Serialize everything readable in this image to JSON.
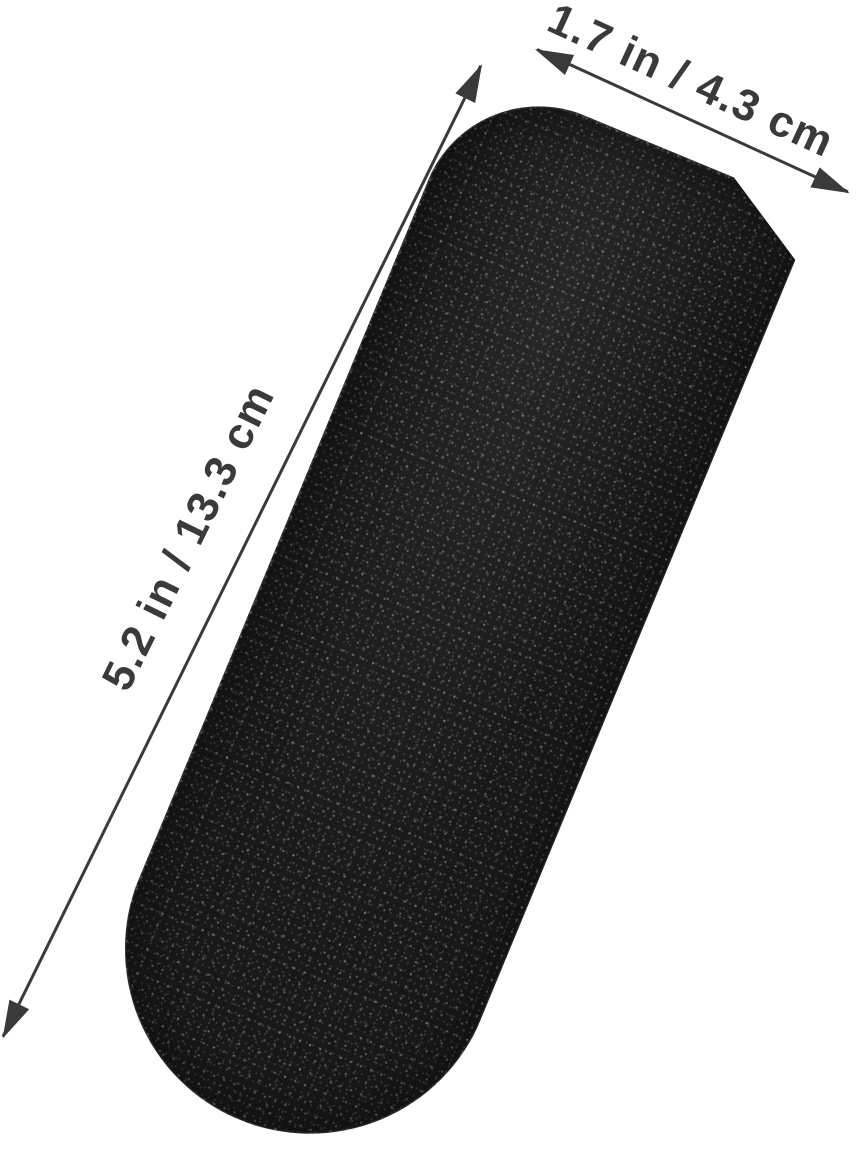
{
  "scene": {
    "background": "#ffffff"
  },
  "pad": {
    "name": "black-abrasive-grit-pad",
    "color": "#191919",
    "speckle_color": "#a8a8a8"
  },
  "annotations": {
    "color": "#3a3a3a",
    "width": {
      "label": "1.7 in / 4.3 cm"
    },
    "length": {
      "label": "5.2 in / 13.3 cm"
    }
  }
}
